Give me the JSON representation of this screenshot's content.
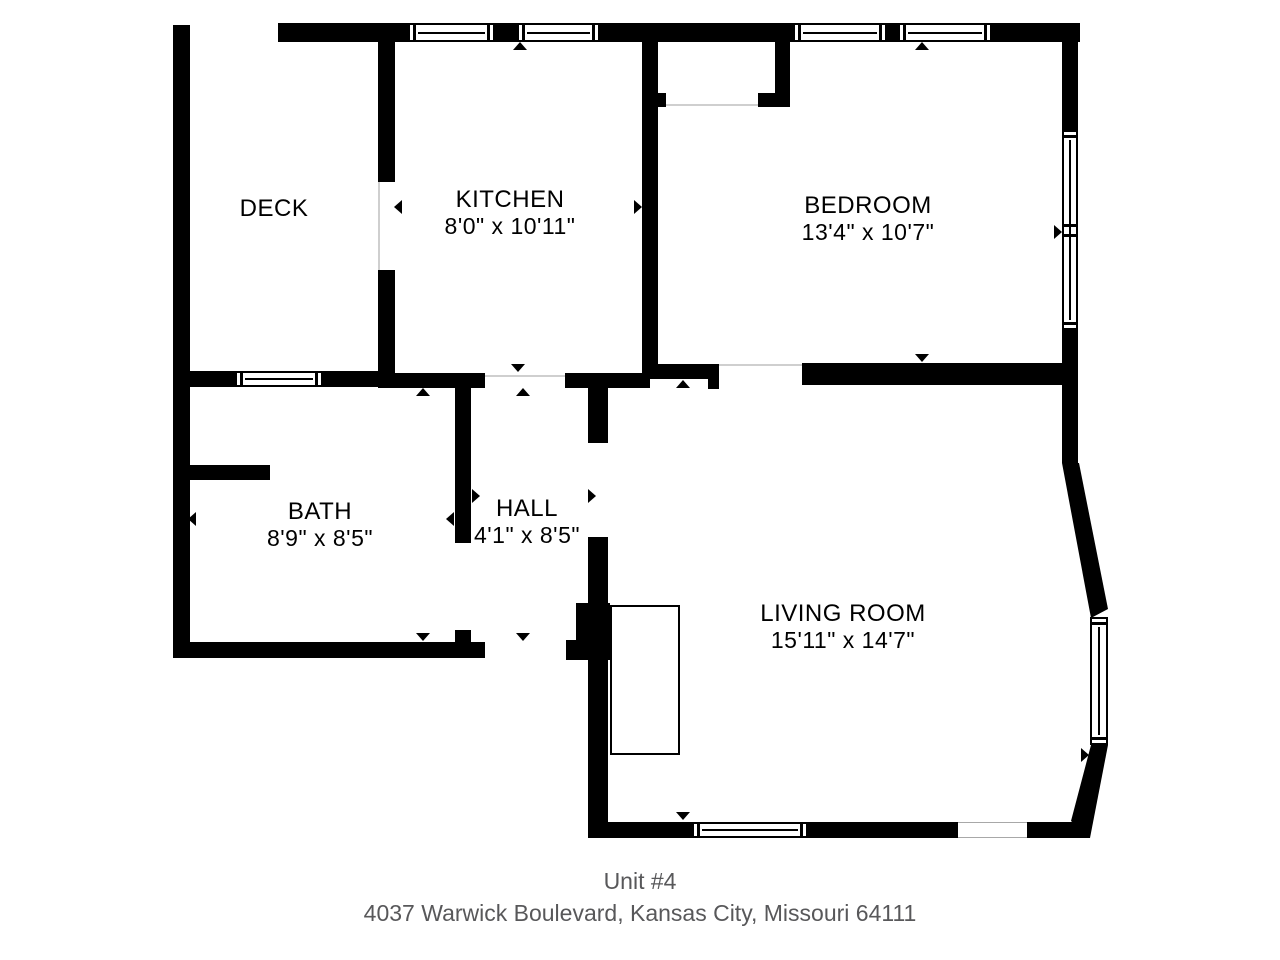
{
  "title": {
    "unit": "Unit #4",
    "address": "4037 Warwick Boulevard, Kansas City, Missouri 64111"
  },
  "colors": {
    "wall": "#000000",
    "caption": "#58585a",
    "door_line": "#cfcfcf"
  },
  "rooms": [
    {
      "id": "deck",
      "name": "DECK",
      "dims": "",
      "cx": 274,
      "top": 195
    },
    {
      "id": "kitchen",
      "name": "KITCHEN",
      "dims": "8'0\" x 10'11\"",
      "cx": 510,
      "top": 186
    },
    {
      "id": "bedroom",
      "name": "BEDROOM",
      "dims": "13'4\" x 10'7\"",
      "cx": 868,
      "top": 192
    },
    {
      "id": "bath",
      "name": "BATH",
      "dims": "8'9\" x 8'5\"",
      "cx": 320,
      "top": 498
    },
    {
      "id": "hall",
      "name": "HALL",
      "dims": "4'1\" x 8'5\"",
      "cx": 527,
      "top": 495
    },
    {
      "id": "living",
      "name": "LIVING ROOM",
      "dims": "15'11\" x 14'7\"",
      "cx": 843,
      "top": 600
    }
  ],
  "geometry": {
    "walls": [
      [
        173,
        25,
        17,
        633
      ],
      [
        278,
        23,
        112,
        19
      ],
      [
        390,
        23,
        18,
        19
      ],
      [
        495,
        23,
        22,
        19
      ],
      [
        600,
        23,
        193,
        19
      ],
      [
        887,
        23,
        11,
        19
      ],
      [
        992,
        23,
        88,
        19
      ],
      [
        378,
        42,
        17,
        140
      ],
      [
        378,
        270,
        17,
        105
      ],
      [
        173,
        371,
        62,
        16
      ],
      [
        323,
        371,
        62,
        16
      ],
      [
        378,
        373,
        107,
        15
      ],
      [
        565,
        373,
        85,
        15
      ],
      [
        642,
        40,
        16,
        337
      ],
      [
        642,
        93,
        24,
        14
      ],
      [
        775,
        42,
        15,
        65
      ],
      [
        758,
        93,
        32,
        14
      ],
      [
        642,
        364,
        77,
        15
      ],
      [
        708,
        379,
        11,
        10
      ],
      [
        802,
        363,
        276,
        22
      ],
      [
        1062,
        42,
        16,
        88
      ],
      [
        1062,
        330,
        16,
        133
      ],
      [
        455,
        388,
        16,
        155
      ],
      [
        455,
        630,
        16,
        28
      ],
      [
        173,
        642,
        312,
        16
      ],
      [
        188,
        465,
        82,
        15
      ],
      [
        588,
        388,
        20,
        55
      ],
      [
        588,
        537,
        20,
        285
      ],
      [
        576,
        603,
        34,
        57
      ],
      [
        566,
        640,
        22,
        20
      ],
      [
        588,
        822,
        104,
        16
      ],
      [
        808,
        822,
        150,
        16
      ],
      [
        1027,
        822,
        63,
        16
      ]
    ],
    "polygons": [
      "1062,463 1079,463 1108,609 1091,618",
      "1091,745 1108,745 1090,838 1071,821"
    ],
    "windows": [
      {
        "x": 408,
        "y": 23,
        "w": 87,
        "h": 19,
        "o": "h"
      },
      {
        "x": 517,
        "y": 23,
        "w": 83,
        "h": 19,
        "o": "h"
      },
      {
        "x": 793,
        "y": 23,
        "w": 94,
        "h": 19,
        "o": "h"
      },
      {
        "x": 898,
        "y": 23,
        "w": 94,
        "h": 19,
        "o": "h"
      },
      {
        "x": 235,
        "y": 371,
        "w": 88,
        "h": 16,
        "o": "h"
      },
      {
        "x": 692,
        "y": 822,
        "w": 116,
        "h": 16,
        "o": "h"
      },
      {
        "x": 1062,
        "y": 130,
        "w": 16,
        "h": 200,
        "o": "v",
        "joint": true
      },
      {
        "x": 1090,
        "y": 617,
        "w": 18,
        "h": 128,
        "o": "v"
      }
    ],
    "plain_gaps": [
      [
        958,
        822,
        69,
        16
      ]
    ],
    "door_lines": [
      [
        378,
        182,
        2,
        88
      ],
      [
        485,
        375,
        80,
        2
      ],
      [
        666,
        104,
        92,
        2
      ],
      [
        719,
        364,
        83,
        2
      ]
    ],
    "stairs": [
      610,
      605,
      70,
      150
    ],
    "arrows": [
      {
        "d": "u",
        "x": 513,
        "y": 42
      },
      {
        "d": "u",
        "x": 915,
        "y": 42
      },
      {
        "d": "u",
        "x": 416,
        "y": 388
      },
      {
        "d": "u",
        "x": 516,
        "y": 388
      },
      {
        "d": "u",
        "x": 676,
        "y": 380
      },
      {
        "d": "d",
        "x": 511,
        "y": 364
      },
      {
        "d": "d",
        "x": 915,
        "y": 354
      },
      {
        "d": "d",
        "x": 416,
        "y": 633
      },
      {
        "d": "d",
        "x": 516,
        "y": 633
      },
      {
        "d": "d",
        "x": 676,
        "y": 812
      },
      {
        "d": "l",
        "x": 188,
        "y": 512
      },
      {
        "d": "l",
        "x": 446,
        "y": 512
      },
      {
        "d": "l",
        "x": 394,
        "y": 200
      },
      {
        "d": "l",
        "x": 649,
        "y": 226
      },
      {
        "d": "l",
        "x": 599,
        "y": 750
      },
      {
        "d": "r",
        "x": 634,
        "y": 200
      },
      {
        "d": "r",
        "x": 472,
        "y": 489
      },
      {
        "d": "r",
        "x": 588,
        "y": 489
      },
      {
        "d": "r",
        "x": 1054,
        "y": 225
      },
      {
        "d": "r",
        "x": 1081,
        "y": 748
      }
    ],
    "caption_top": 868
  }
}
